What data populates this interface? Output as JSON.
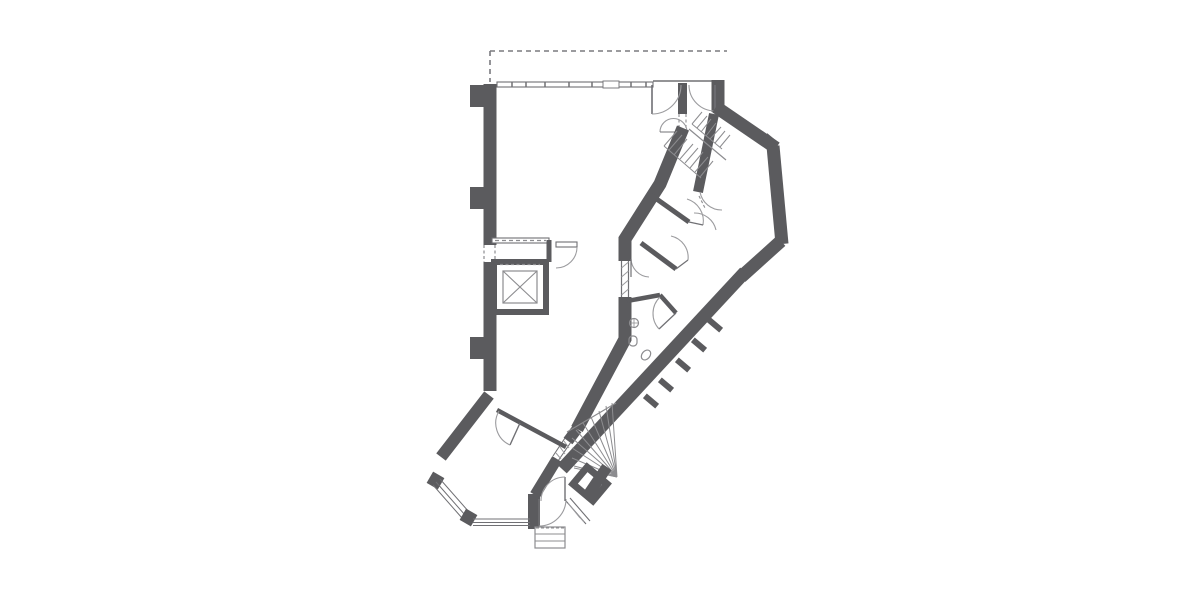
{
  "page": {
    "width": 1200,
    "height": 600,
    "background": "#ffffff",
    "title": ""
  },
  "colors": {
    "wall": "#5b5b5e",
    "thin": "#707074",
    "med": "#8c8c8f",
    "arc": "#9b9b9e",
    "hatch": "#9b9b9e",
    "dash": "#7a7a7e",
    "white": "#ffffff"
  },
  "plan": {
    "label": "architectural-floor-plan",
    "features": [
      "canopy-dashed-outline",
      "exterior-walls",
      "window-walls",
      "double-entrance-doors-top",
      "dog-leg-stair-upper",
      "winder-stair-lower",
      "elevator-shaft-with-cross",
      "elevator-lobby",
      "wc-room-with-sink-and-toilets",
      "small-rooms-along-diagonal-wing",
      "bay-windows-lower-left",
      "entry-vestibule-with-steps",
      "duct-room-square",
      "wall-piers"
    ],
    "primitives": [
      {
        "t": "path",
        "name": "canopy-dashed-line",
        "d": "M490,51 H727",
        "role": "dash",
        "w": 1.6,
        "dash": "5,4"
      },
      {
        "t": "path",
        "name": "canopy-dashed-line",
        "d": "M490,51 V82",
        "role": "dash",
        "w": 1.6,
        "dash": "5,4"
      },
      {
        "t": "path",
        "name": "wall-left",
        "d": "M490,84 V391",
        "role": "wall",
        "w": 13
      },
      {
        "t": "rect",
        "name": "wall-pilaster",
        "x": 470,
        "y": 85,
        "wd": 14,
        "ht": 22,
        "fillRole": "wall"
      },
      {
        "t": "rect",
        "name": "wall-pilaster",
        "x": 470,
        "y": 187,
        "wd": 14,
        "ht": 22,
        "fillRole": "wall"
      },
      {
        "t": "rect",
        "name": "wall-pilaster",
        "x": 470,
        "y": 337,
        "wd": 14,
        "ht": 22,
        "fillRole": "wall"
      },
      {
        "t": "rect",
        "name": "window-wall-top",
        "x": 497,
        "y": 82,
        "wd": 156,
        "ht": 5,
        "fill": "#ffffff",
        "role": "thin",
        "w": 1.1
      },
      {
        "t": "path",
        "name": "window-mullion-ticks",
        "d": "M512,82 v5 M526,82 v5 M545,82 v5 M569,82 v5 M592,82 v5 M631,82 v5 M646,82 v5",
        "role": "thin",
        "w": 1.5
      },
      {
        "t": "rect",
        "name": "window-break",
        "x": 603,
        "y": 81,
        "wd": 16,
        "ht": 7,
        "fill": "#ffffff",
        "role": "thin",
        "w": 0.9
      },
      {
        "t": "path",
        "name": "door-head-line",
        "d": "M653,81 H724",
        "role": "thin",
        "w": 1.4
      },
      {
        "t": "rect",
        "name": "wall-door-post",
        "x": 678,
        "y": 83,
        "wd": 9,
        "ht": 31,
        "fillRole": "wall"
      },
      {
        "t": "path",
        "name": "door-opening-dashed",
        "d": "M679,114 V131 M686,114 V131",
        "role": "med",
        "w": 1.1,
        "dash": "3,2.5"
      },
      {
        "t": "path",
        "name": "wall-top-right",
        "d": "M718,80 V112",
        "role": "wall",
        "w": 13
      },
      {
        "t": "path",
        "name": "door-leaf",
        "d": "M652,85 V114",
        "role": "thin",
        "w": 1.6
      },
      {
        "t": "path",
        "name": "door-swing-arc",
        "d": "M681,85 A29,29 0 0 1 652,114",
        "role": "arc",
        "w": 1.1
      },
      {
        "t": "path",
        "name": "door-leaf",
        "d": "M715,85 V111",
        "role": "thin",
        "w": 1.6
      },
      {
        "t": "path",
        "name": "door-swing-arc",
        "d": "M689,85 A26,26 0 0 0 715,111",
        "role": "arc",
        "w": 1.1
      },
      {
        "t": "path",
        "name": "door-swing-arc",
        "d": "M660,132 A13.5,13.5 0 0 1 687,132",
        "role": "arc",
        "w": 1.1
      },
      {
        "t": "path",
        "name": "door-leaf",
        "d": "M660,132 H687",
        "role": "thin",
        "w": 1
      },
      {
        "t": "path",
        "name": "wall-wing-top",
        "d": "M716,107 L776,148",
        "role": "wall",
        "w": 13
      },
      {
        "t": "rect",
        "name": "wall-notch",
        "x": 763,
        "y": 136,
        "wd": 12,
        "ht": 9,
        "fillRole": "wall",
        "rot": 40
      },
      {
        "t": "path",
        "name": "wall-wing-right",
        "d": "M773,146 L782,244",
        "role": "wall",
        "w": 13
      },
      {
        "t": "path",
        "name": "wall-wing-bottom",
        "d": "M781,241 L741,277",
        "role": "wall",
        "w": 13
      },
      {
        "t": "path",
        "name": "wall-band-outer",
        "d": "M745,272 L562,469",
        "role": "wall",
        "w": 13
      },
      {
        "t": "rect",
        "name": "wall-pier",
        "x": 712,
        "y": 317,
        "wd": 6,
        "ht": 16,
        "fillRole": "wall",
        "rot": -50
      },
      {
        "t": "rect",
        "name": "wall-pier",
        "x": 696,
        "y": 337,
        "wd": 6,
        "ht": 16,
        "fillRole": "wall",
        "rot": -50
      },
      {
        "t": "rect",
        "name": "wall-pier",
        "x": 680,
        "y": 357,
        "wd": 6,
        "ht": 16,
        "fillRole": "wall",
        "rot": -50
      },
      {
        "t": "rect",
        "name": "wall-pier",
        "x": 663,
        "y": 377,
        "wd": 6,
        "ht": 16,
        "fillRole": "wall",
        "rot": -50
      },
      {
        "t": "rect",
        "name": "wall-pier",
        "x": 648,
        "y": 393,
        "wd": 6,
        "ht": 16,
        "fillRole": "wall",
        "rot": -50
      },
      {
        "t": "path",
        "name": "wall-wing-room-left",
        "d": "M714,114 L698,192",
        "role": "wall",
        "w": 10
      },
      {
        "t": "path",
        "name": "wall-band-inner-upper",
        "d": "M683,128 L660,184 L625,239 V261",
        "role": "wall",
        "w": 13
      },
      {
        "t": "path",
        "name": "window-frame",
        "d": "M621.5,261 V297 M628.5,261 V297",
        "role": "thin",
        "w": 1.2
      },
      {
        "t": "path",
        "name": "window-hatch",
        "d": "M621.5,268 L628.5,262 M621.5,277 L628.5,271 M621.5,286 L628.5,280 M621.5,295 L628.5,289",
        "role": "hatch",
        "w": 1
      },
      {
        "t": "path",
        "name": "wall-band-inner-mid",
        "d": "M625,297 V339 L577,429",
        "role": "wall",
        "w": 13
      },
      {
        "t": "path",
        "name": "wall-stair-left",
        "d": "M577,429 L568,441",
        "role": "wall",
        "w": 11
      },
      {
        "t": "path",
        "name": "window-frame",
        "d": "M565,438 L553,456 M571,442 L558,461",
        "role": "thin",
        "w": 1.1
      },
      {
        "t": "path",
        "name": "window-hatch",
        "d": "M564,441 L569,448 M560,447 L565,454 M556,453 L561,459",
        "role": "hatch",
        "w": 1
      },
      {
        "t": "path",
        "name": "wall-vestibule-left-diag",
        "d": "M557,459 L535,495",
        "role": "wall",
        "w": 11
      },
      {
        "t": "path",
        "name": "wall-vestibule-left",
        "d": "M534,494 V529",
        "role": "wall",
        "w": 12
      },
      {
        "t": "path",
        "name": "wall-bay-upper",
        "d": "M489,395 L441,457",
        "role": "wall",
        "w": 12
      },
      {
        "t": "rect",
        "name": "wall-corner-stub",
        "x": 429,
        "y": 474,
        "wd": 13,
        "ht": 13,
        "fillRole": "wall",
        "rot": 30
      },
      {
        "t": "path",
        "name": "window-frame",
        "d": "M436,482 L465,515 M440,479 L469,512 M433,485 L462,518",
        "role": "thin",
        "w": 1
      },
      {
        "t": "rect",
        "name": "wall-corner-stub",
        "x": 462,
        "y": 511,
        "wd": 13,
        "ht": 13,
        "fillRole": "wall",
        "rot": 30
      },
      {
        "t": "path",
        "name": "window-frame",
        "d": "M473,519 H530 M473,522.5 H530 M473,525.5 H530",
        "role": "thin",
        "w": 1
      },
      {
        "t": "path",
        "name": "wall-bay-partition",
        "d": "M497,410 L566,447",
        "role": "wall",
        "w": 4.5
      },
      {
        "t": "path",
        "name": "door-leaf",
        "d": "M520,423 L510,445",
        "role": "thin",
        "w": 1.4
      },
      {
        "t": "path",
        "name": "door-swing-arc",
        "d": "M499,411 A24,24 0 0 0 510,445",
        "role": "arc",
        "w": 1.1
      },
      {
        "t": "rect",
        "name": "elevator-lobby-wall",
        "x": 492,
        "y": 238,
        "wd": 57,
        "ht": 5,
        "fill": "#ffffff",
        "role": "thin",
        "w": 1.1
      },
      {
        "t": "path",
        "name": "wall-opening-dashed",
        "d": "M495,240.5 H546",
        "role": "med",
        "w": 1.3,
        "dash": "4,3"
      },
      {
        "t": "path",
        "name": "wall-lobby-right",
        "d": "M549,240 V262",
        "role": "wall",
        "w": 5
      },
      {
        "t": "rect",
        "name": "door-leaf",
        "x": 556,
        "y": 242,
        "wd": 21,
        "ht": 5,
        "fill": "#ffffff",
        "role": "thin",
        "w": 1.1
      },
      {
        "t": "path",
        "name": "door-swing-arc",
        "d": "M577,247 A21,21 0 0 1 556,268",
        "role": "arc",
        "w": 1.1
      },
      {
        "t": "rect",
        "name": "wall-opening",
        "x": 482,
        "y": 245,
        "wd": 16,
        "ht": 17,
        "fill": "#ffffff"
      },
      {
        "t": "path",
        "name": "wall-opening-dashed",
        "d": "M484,245 V262 M495,245 V262",
        "role": "med",
        "w": 1.2,
        "dash": "3,2.5"
      },
      {
        "t": "rect",
        "name": "elevator-shaft",
        "x": 494,
        "y": 262,
        "wd": 52,
        "ht": 50,
        "fill": "none",
        "role": "wall",
        "w": 6
      },
      {
        "t": "rect",
        "name": "elevator-cab",
        "x": 503,
        "y": 271,
        "wd": 34,
        "ht": 32,
        "fill": "none",
        "role": "med",
        "w": 1.2
      },
      {
        "t": "path",
        "name": "elevator-cross",
        "d": "M503,271 L537,303 M537,271 L503,303",
        "role": "med",
        "w": 1.1
      },
      {
        "t": "path",
        "name": "elevator-door-dashed",
        "d": "M500,264.5 H540",
        "role": "med",
        "w": 1.2,
        "dash": "3,2.5"
      },
      {
        "t": "path",
        "name": "stair-treads",
        "d": "M692,124 L702,112 M697,128 L707,116 M701,132 L711,119 M706,136 L716,123 M710,139 L721,127 M715,143 L725,131 M720,147 L730,135",
        "role": "med",
        "w": 1
      },
      {
        "t": "path",
        "name": "stair-treads",
        "d": "M664,146 L677,131 M669,150 L682,135 M674,155 L687,139 M680,159 L693,144 M685,163 L698,148 M690,168 L703,152 M695,172 L708,157 M700,177 L713,161",
        "role": "med",
        "w": 1
      },
      {
        "t": "path",
        "name": "stair-divider",
        "d": "M689,129 L726,160",
        "role": "med",
        "w": 1.2
      },
      {
        "t": "path",
        "name": "stair-edge",
        "d": "M692,124 L722,149 M664,146 L701,178",
        "role": "med",
        "w": 1
      },
      {
        "t": "path",
        "name": "wall-partition",
        "d": "M651,195 L689,222",
        "role": "wall",
        "w": 5
      },
      {
        "t": "path",
        "name": "door-swing-arc",
        "d": "M687,199 A23,23 0 0 1 703,225",
        "role": "arc",
        "w": 1.1
      },
      {
        "t": "path",
        "name": "door-leaf",
        "d": "M689,222 L703,225",
        "role": "thin",
        "w": 1.2
      },
      {
        "t": "path",
        "name": "wall-partition",
        "d": "M641,243 L676,269",
        "role": "wall",
        "w": 5
      },
      {
        "t": "path",
        "name": "door-swing-arc",
        "d": "M671,236 A22,22 0 0 1 688,260",
        "role": "arc",
        "w": 1.1
      },
      {
        "t": "path",
        "name": "door-leaf",
        "d": "M676,269 L688,260",
        "role": "thin",
        "w": 1.2
      },
      {
        "t": "path",
        "name": "door-swing-arc",
        "d": "M631,259 A19,19 0 0 0 649,277",
        "role": "arc",
        "w": 1.1
      },
      {
        "t": "path",
        "name": "door-leaf",
        "d": "M631,259 V277",
        "role": "thin",
        "w": 1.2
      },
      {
        "t": "path",
        "name": "door-swing-arc",
        "d": "M700,192 A22,22 0 0 0 722,210",
        "role": "arc",
        "w": 1.1
      },
      {
        "t": "path",
        "name": "door-swing-arc",
        "d": "M694,213 A22,22 0 0 1 716,230",
        "role": "arc",
        "w": 1.1
      },
      {
        "t": "path",
        "name": "wall-opening-dashed",
        "d": "M699,196 L705,208",
        "role": "med",
        "w": 1.1,
        "dash": "3,2"
      },
      {
        "t": "path",
        "name": "wall-wc",
        "d": "M627,301 L660,295",
        "role": "wall",
        "w": 4.5
      },
      {
        "t": "path",
        "name": "wall-wc",
        "d": "M660,295 L676,313",
        "role": "wall",
        "w": 4.5
      },
      {
        "t": "path",
        "name": "door-leaf",
        "d": "M676,313 L659,329",
        "role": "thin",
        "w": 1.3
      },
      {
        "t": "path",
        "name": "door-swing-arc",
        "d": "M660,297 A23,23 0 0 0 659,329",
        "role": "arc",
        "w": 1.1
      },
      {
        "t": "circle",
        "name": "wc-sink",
        "cx": 634,
        "cy": 323,
        "r": 4.5,
        "fill": "none",
        "role": "med",
        "w": 1.2
      },
      {
        "t": "path",
        "name": "wc-sink-tap",
        "d": "M630,323 H638 M634,319 V327",
        "role": "med",
        "w": 0.8
      },
      {
        "t": "rect",
        "name": "wc-toilet",
        "x": 629,
        "y": 336,
        "wd": 8,
        "ht": 10,
        "rx": 3.5,
        "fill": "none",
        "role": "med",
        "w": 1.2
      },
      {
        "t": "ellipse",
        "name": "wc-fixture",
        "cx": 646,
        "cy": 355,
        "rx": 4,
        "ry": 5.5,
        "rot": 40,
        "fill": "none",
        "role": "med",
        "w": 1.2
      },
      {
        "t": "path",
        "name": "stair-winder-treads",
        "d": "M617,477 L572,438 M617,477 L576,430 M617,477 L583,423 M617,477 L591,417 M617,477 L599,411 M617,477 L606,406 M617,477 L612,403 M617,477 L572,448 M617,477 L572,458 M617,477 L574,466",
        "role": "med",
        "w": 1
      },
      {
        "t": "path",
        "name": "stair-edge",
        "d": "M567,432 L616,403",
        "role": "med",
        "w": 1.2
      },
      {
        "t": "path",
        "name": "stair-edge",
        "d": "M574,468 L617,477",
        "role": "med",
        "w": 1
      },
      {
        "t": "rect",
        "name": "duct-room",
        "x": 577,
        "y": 473,
        "wd": 26,
        "ht": 22,
        "fill": "#ffffff",
        "role": "wall",
        "w": 7,
        "rot": 40
      },
      {
        "t": "path",
        "name": "wall-entry-right",
        "d": "M607,467 L586,498",
        "role": "wall",
        "w": 11
      },
      {
        "t": "path",
        "name": "window-frame",
        "d": "M566,501 L586,524 M570,498 L590,521",
        "role": "thin",
        "w": 1.1
      },
      {
        "t": "path",
        "name": "window-hatch",
        "d": "M568,503 L576,513 M572,508 L580,518 M576,513 L584,522",
        "role": "hatch",
        "w": 1
      },
      {
        "t": "path",
        "name": "door-leaf",
        "d": "M539,499 V526",
        "role": "thin",
        "w": 1.4
      },
      {
        "t": "path",
        "name": "door-swing-arc",
        "d": "M566,499 A27,27 0 0 1 539,526",
        "role": "arc",
        "w": 1.1
      },
      {
        "t": "path",
        "name": "door-leaf",
        "d": "M565,501 V477",
        "role": "thin",
        "w": 1.4
      },
      {
        "t": "path",
        "name": "door-swing-arc",
        "d": "M541,501 A24,24 0 0 1 565,477",
        "role": "arc",
        "w": 1.1
      },
      {
        "t": "rect",
        "name": "entry-steps",
        "x": 535,
        "y": 527,
        "wd": 30,
        "ht": 21,
        "fill": "#ffffff",
        "role": "med",
        "w": 1.2
      },
      {
        "t": "path",
        "name": "entry-step-lines",
        "d": "M535,534 H565 M535,541 H565",
        "role": "med",
        "w": 1
      },
      {
        "t": "path",
        "name": "entry-threshold-dashed",
        "d": "M536,528 H564",
        "role": "med",
        "w": 1,
        "dash": "3,2"
      }
    ]
  }
}
